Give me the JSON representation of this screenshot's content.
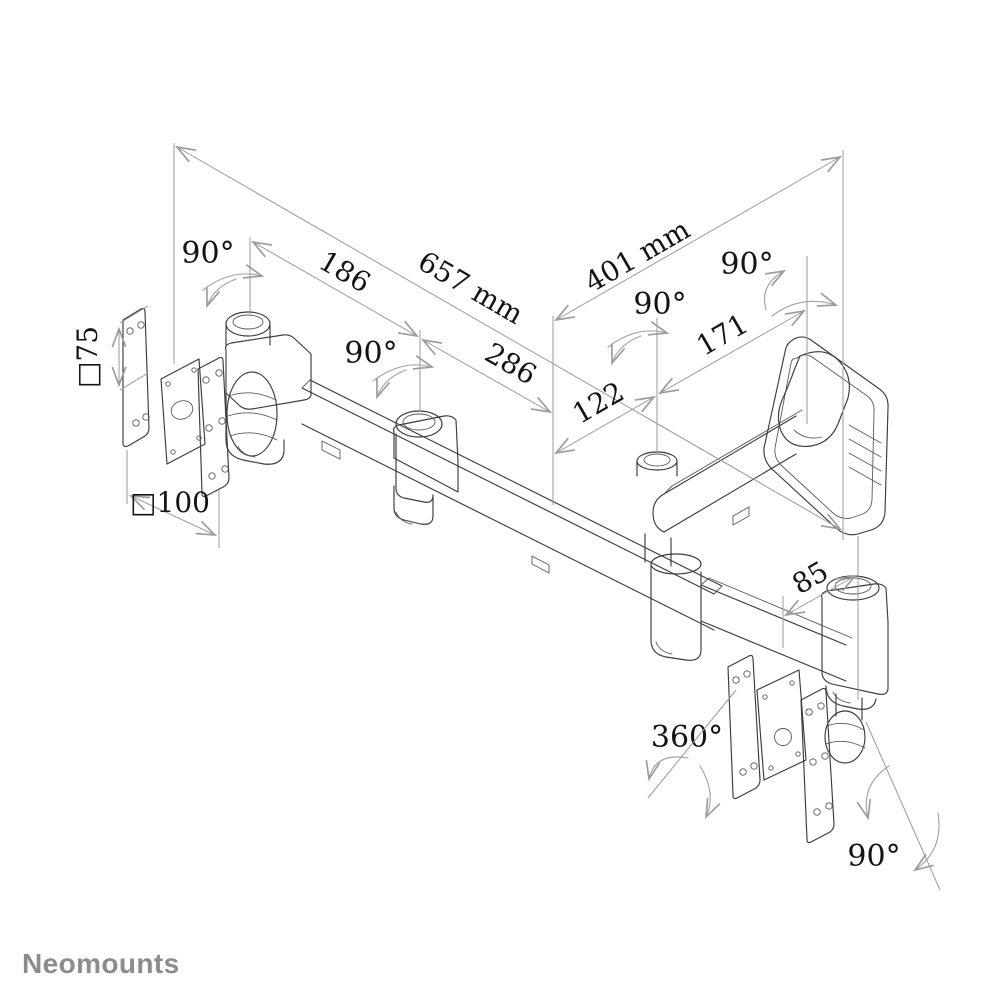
{
  "canvas": {
    "width": 1004,
    "height": 1004,
    "background": "#ffffff"
  },
  "brand": {
    "logo_text": "Neomounts",
    "logo_color": "#8c8c8c"
  },
  "drawing": {
    "kind": "isometric dimension line drawing",
    "subject": "dual-monitor swivel wall mount with two VESA plates and wall bracket",
    "line_color": "#3c3c3c",
    "dimension_line_color": "#9b9b9b",
    "text_color": "#141414"
  },
  "dimensions": {
    "total_reach": "657 mm",
    "wall_arm_reach": "401 mm",
    "segment_left": "186",
    "segment_mid": "286",
    "depth_inner": "122",
    "depth_outer": "171",
    "head_offset": "85",
    "vesa_small": "□75",
    "vesa_large": "□100"
  },
  "angles": {
    "swivel_left_head": "90°",
    "swivel_mid_joint": "90°",
    "swivel_junction": "90°",
    "swivel_wall_joint": "90°",
    "head_rotation": "360°",
    "head_tilt": "90°"
  }
}
